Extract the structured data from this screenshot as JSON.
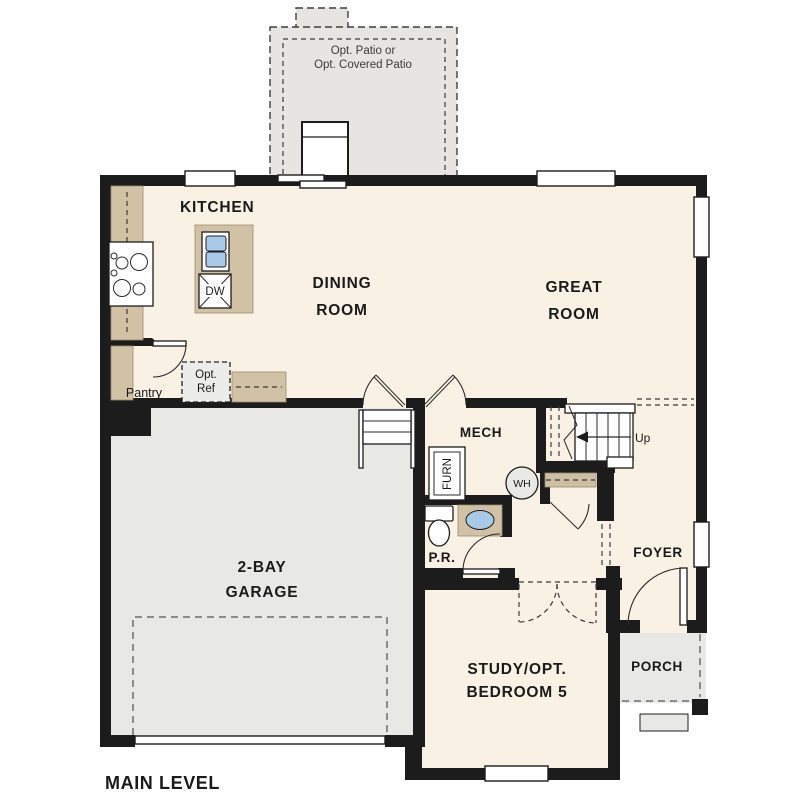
{
  "plan": {
    "title": "MAIN LEVEL",
    "patio": {
      "line1": "Opt. Patio or",
      "line2": "Opt. Covered Patio"
    },
    "rooms": {
      "kitchen": "KITCHEN",
      "dining1": "DINING",
      "dining2": "ROOM",
      "great1": "GREAT",
      "great2": "ROOM",
      "mech": "MECH",
      "pr": "P.R.",
      "foyer": "FOYER",
      "porch": "PORCH",
      "garage1": "2-BAY",
      "garage2": "GARAGE",
      "study1": "STUDY/OPT.",
      "study2": "BEDROOM 5",
      "pantry": "Pantry"
    },
    "fixtures": {
      "dw": "DW",
      "furn": "FURN",
      "wh": "WH",
      "opt_ref1": "Opt.",
      "opt_ref2": "Ref",
      "up": "Up"
    },
    "colors": {
      "wall": "#1c1c1c",
      "floor": "#f8f1e4",
      "garage_floor": "#e8e8e5",
      "patio": "#e6e5e1",
      "counter": "#d1c2a6",
      "sink_blue": "#a9c9e9",
      "text": "#1a1a1a"
    }
  }
}
